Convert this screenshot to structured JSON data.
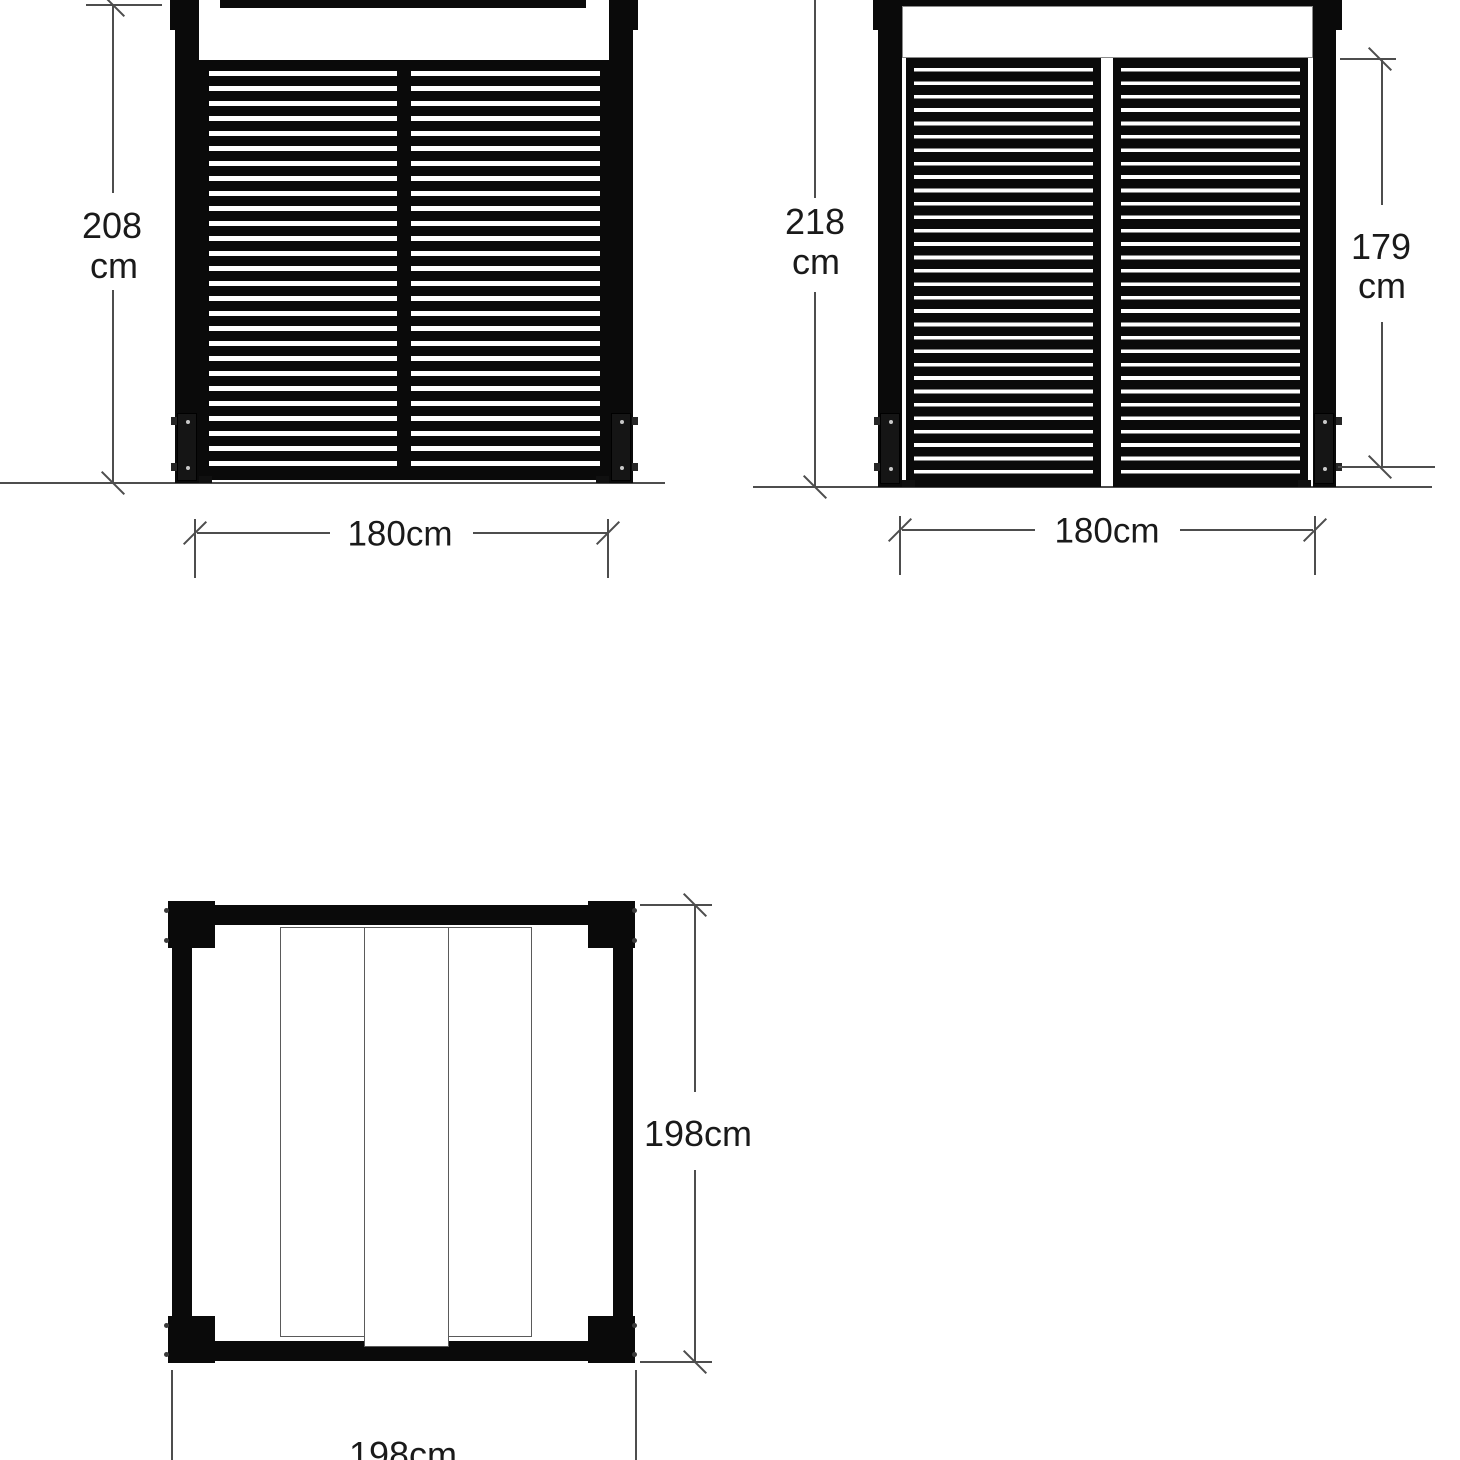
{
  "views": {
    "front_elevation": {
      "overall_height": "208",
      "overall_height_unit": "cm",
      "width": "180cm"
    },
    "rear_elevation": {
      "overall_height": "218",
      "overall_height_unit": "cm",
      "panel_height": "179",
      "panel_height_unit": "cm",
      "width": "180cm"
    },
    "plan": {
      "depth": "198cm",
      "width": "198cm"
    }
  },
  "colors": {
    "ink": "#0a0a0a",
    "dimension_line": "#4d4d4d",
    "text": "#1a1a1a",
    "background": "#ffffff"
  }
}
